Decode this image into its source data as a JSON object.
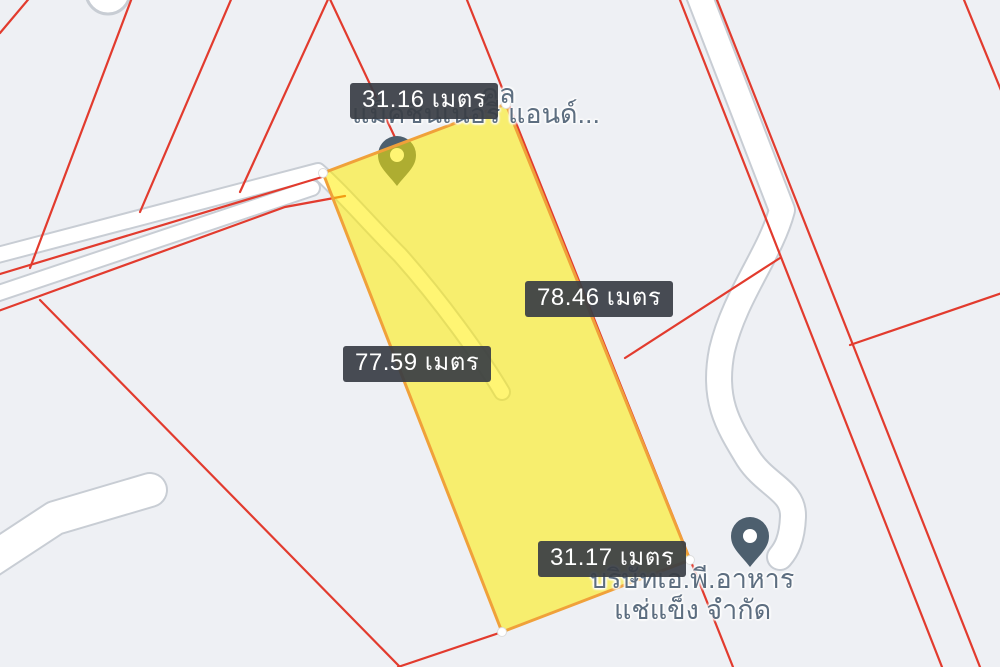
{
  "map": {
    "background_color": "#eef0f4",
    "boundary_line_color": "#e23b2e",
    "road_fill_color": "#ffffff",
    "road_casing_color": "#c8cdd4",
    "pin_color": "#4d5f6e",
    "parcel": {
      "fill_color": "#ffee00",
      "border_color": "#f0a13a",
      "shape": "quadrilateral"
    },
    "measurement_labels": {
      "top": "31.16 เมตร",
      "right": "78.46 เมตร",
      "left": "77.59 เมตร",
      "bottom": "31.17 เมตร"
    },
    "poi_top": {
      "line1_partial": "คล",
      "line2": "แม็คชีนเนอรี แอนด์..."
    },
    "poi_bottom": {
      "line1": "บริษัทเอ.พี.อาหาร",
      "line2": "แช่แข็ง จำกัด"
    }
  }
}
